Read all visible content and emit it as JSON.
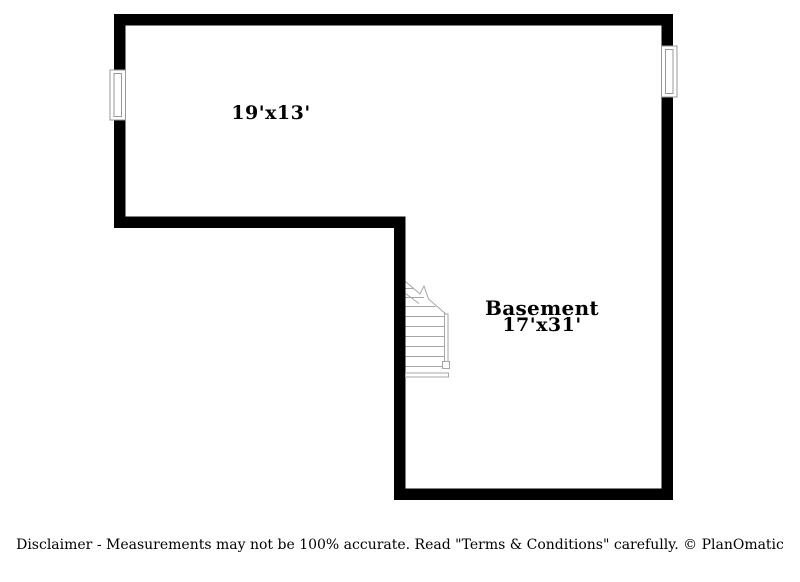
{
  "floor_plan": {
    "rooms": [
      {
        "dimensions": "19'x13'"
      },
      {
        "name": "Basement",
        "dimensions": "17'x31'"
      }
    ],
    "colors": {
      "wall": "#000000",
      "stair_outline": "#a6a6a6",
      "label_text": "#000000",
      "background": "#ffffff"
    }
  },
  "footer": {
    "disclaimer": "Disclaimer - Measurements may not be 100% accurate. Read \"Terms & Conditions\" carefully. © PlanOmatic"
  }
}
